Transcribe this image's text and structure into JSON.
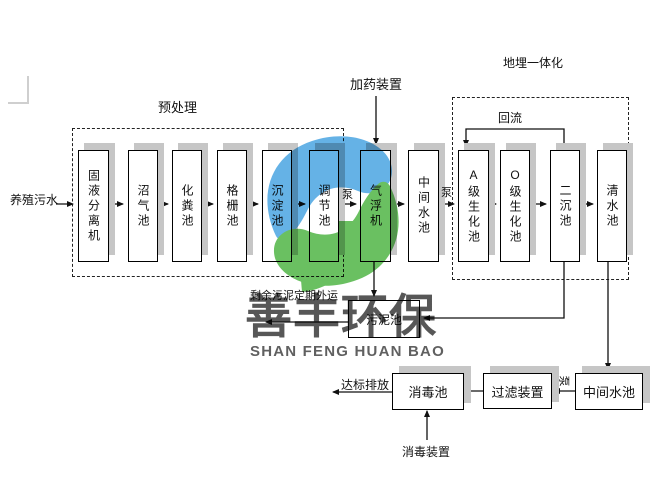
{
  "title": "养殖污水处理工艺流程图",
  "labels": {
    "influent": "养殖污水",
    "pretreatment": "预处理",
    "dosing_device": "加药装置",
    "buried_integrated": "地埋一体化",
    "reflux": "回流",
    "pump": "泵",
    "sludge_out": "剩余污泥定期外运",
    "discharge": "达标排放",
    "disinfect_device": "消毒装置"
  },
  "stages": [
    "固液分离机",
    "沼气池",
    "化粪池",
    "格栅池",
    "沉淀池",
    "调节池",
    "气浮机",
    "中间水池",
    "A级生化池",
    "O级生化池",
    "二沉池",
    "清水池"
  ],
  "bottom_boxes": {
    "sludge_pool": "污泥池",
    "disinfect_pool": "消毒池",
    "filter_device": "过滤装置",
    "intermediate_pool": "中间水池"
  },
  "watermark": {
    "cn": "善丰环保",
    "en": "SHAN FENG HUAN BAO",
    "logo_blue": "#4FA8E3",
    "logo_green": "#55B74B"
  },
  "colors": {
    "box_border": "#000000",
    "box_shadow": "#c6c6c6",
    "line": "#1a1a1a",
    "background": "#ffffff"
  }
}
